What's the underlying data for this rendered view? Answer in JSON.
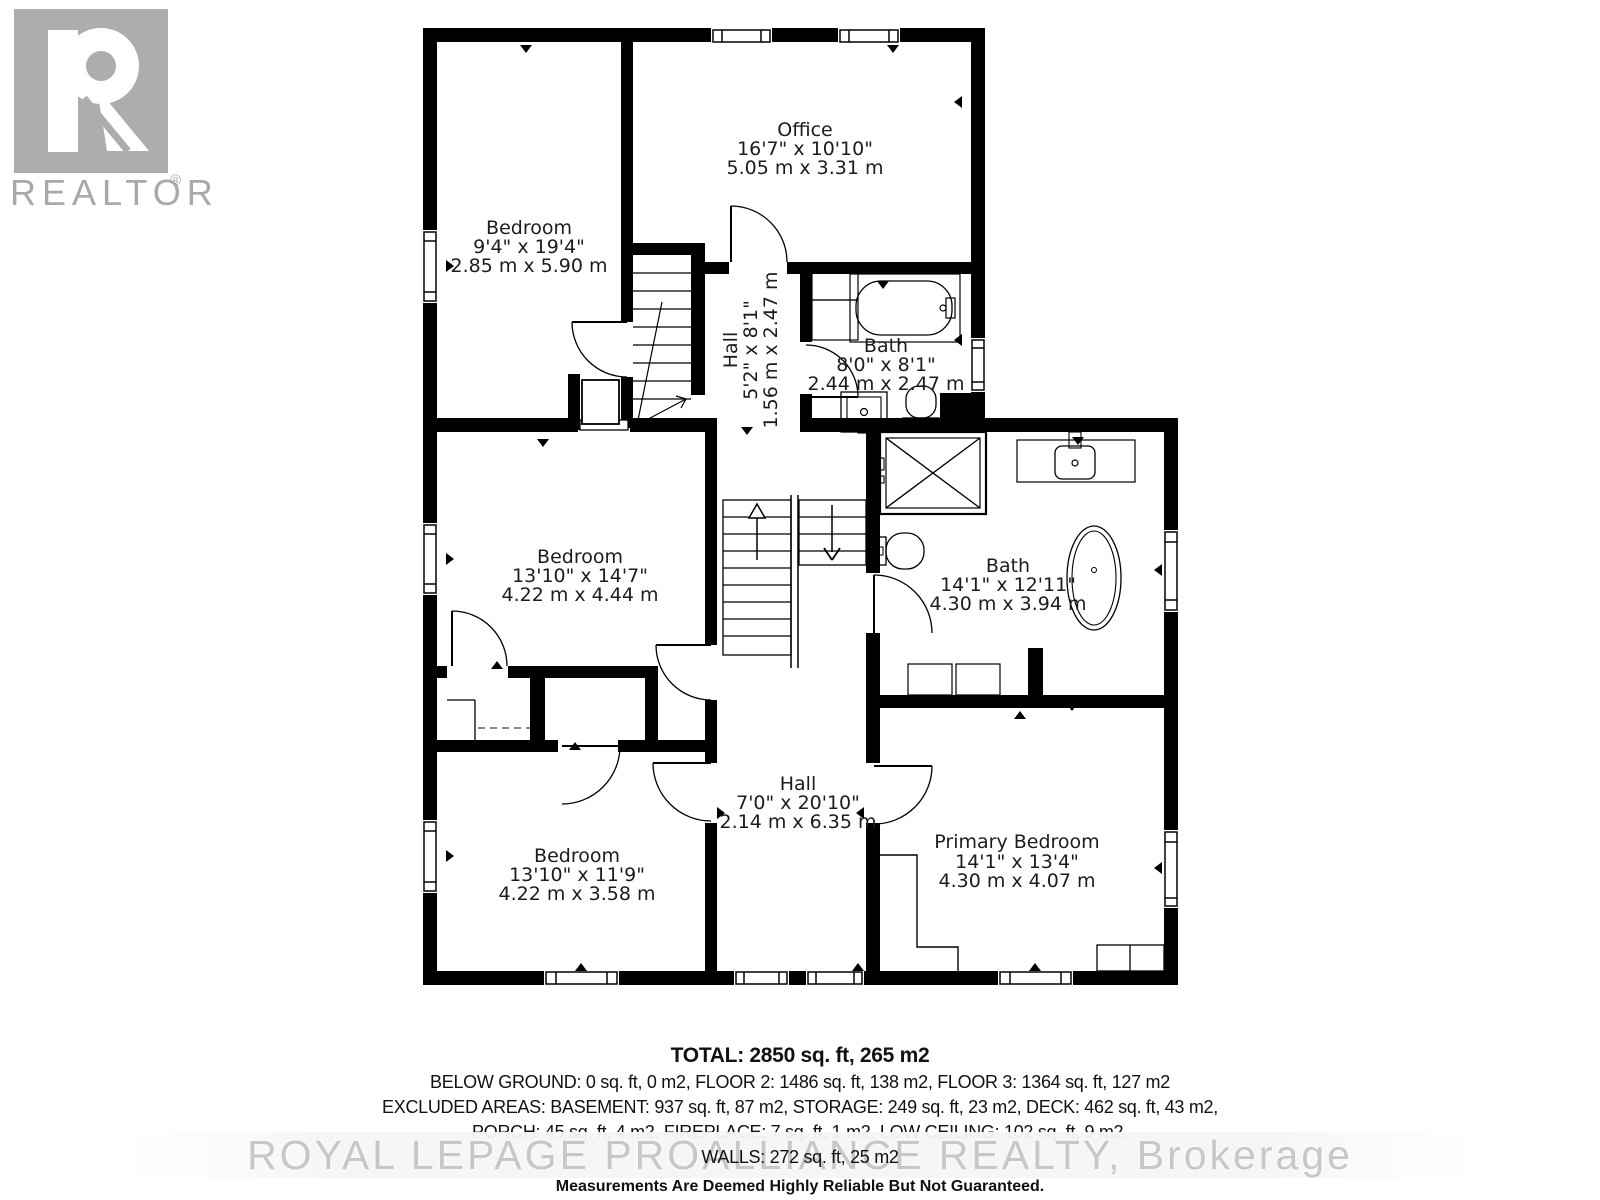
{
  "branding": {
    "logo_r": "R",
    "logo_label": "REALTOR",
    "registered": "®",
    "watermark": "ROYAL LEPAGE PROALLIANCE REALTY, Brokerage"
  },
  "rooms": {
    "bedroom_top": {
      "name": "Bedroom",
      "imperial": "9'4\" x 19'4\"",
      "metric": "2.85 m x 5.90 m"
    },
    "office": {
      "name": "Office",
      "imperial": "16'7\" x 10'10\"",
      "metric": "5.05 m x 3.31 m"
    },
    "hall_upper": {
      "name": "Hall",
      "imperial": "5'2\" x 8'1\"",
      "metric": "1.56 m x 2.47 m"
    },
    "bath_upper": {
      "name": "Bath",
      "imperial": "8'0\" x 8'1\"",
      "metric": "2.44 m x 2.47 m"
    },
    "bedroom_middle": {
      "name": "Bedroom",
      "imperial": "13'10\" x 14'7\"",
      "metric": "4.22 m x 4.44 m"
    },
    "bath_main": {
      "name": "Bath",
      "imperial": "14'1\" x 12'11\"",
      "metric": "4.30 m x 3.94 m"
    },
    "bedroom_bottom": {
      "name": "Bedroom",
      "imperial": "13'10\" x 11'9\"",
      "metric": "4.22 m x 3.58 m"
    },
    "hall_lower": {
      "name": "Hall",
      "imperial": "7'0\" x 20'10\"",
      "metric": "2.14 m x 6.35 m"
    },
    "primary_bedroom": {
      "name": "Primary Bedroom",
      "imperial": "14'1\" x 13'4\"",
      "metric": "4.30 m x 4.07 m"
    }
  },
  "summary": {
    "total": "TOTAL: 2850 sq. ft, 265 m2",
    "floors_line": "BELOW GROUND: 0 sq. ft, 0 m2, FLOOR 2: 1486 sq. ft, 138 m2, FLOOR 3: 1364 sq. ft, 127 m2",
    "excluded_line": "EXCLUDED AREAS: BASEMENT: 937 sq. ft, 87 m2, STORAGE: 249 sq. ft, 23 m2, DECK: 462 sq. ft, 43 m2,",
    "porch_line": "PORCH: 45 sq. ft, 4 m2, FIREPLACE: 7 sq. ft, 1 m2, LOW CEILING: 102 sq. ft, 9 m2,",
    "walls_line": "WALLS: 272 sq. ft, 25 m2",
    "disclaimer": "Measurements Are Deemed Highly Reliable But Not Guaranteed."
  },
  "colors": {
    "wall": "#000000",
    "label": "#1c1c1c",
    "logo_gray": "#a9a9a9",
    "watermark_gray": "#c7c7c7"
  }
}
